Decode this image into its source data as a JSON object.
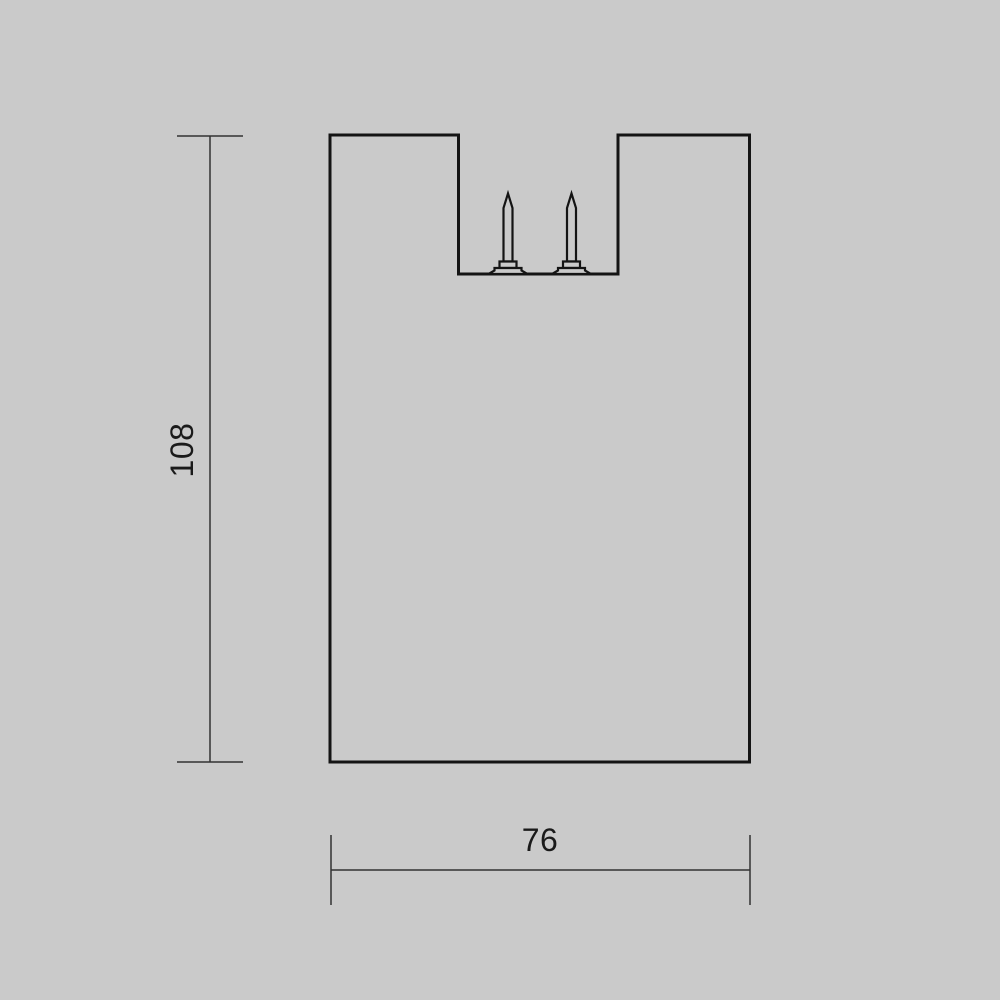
{
  "colors": {
    "background": "#cacaca",
    "outline": "#141414",
    "dimension_line": "#333333",
    "text": "#1a1a1a"
  },
  "dimensions": {
    "height": {
      "value": "108"
    },
    "width": {
      "value": "76"
    }
  }
}
